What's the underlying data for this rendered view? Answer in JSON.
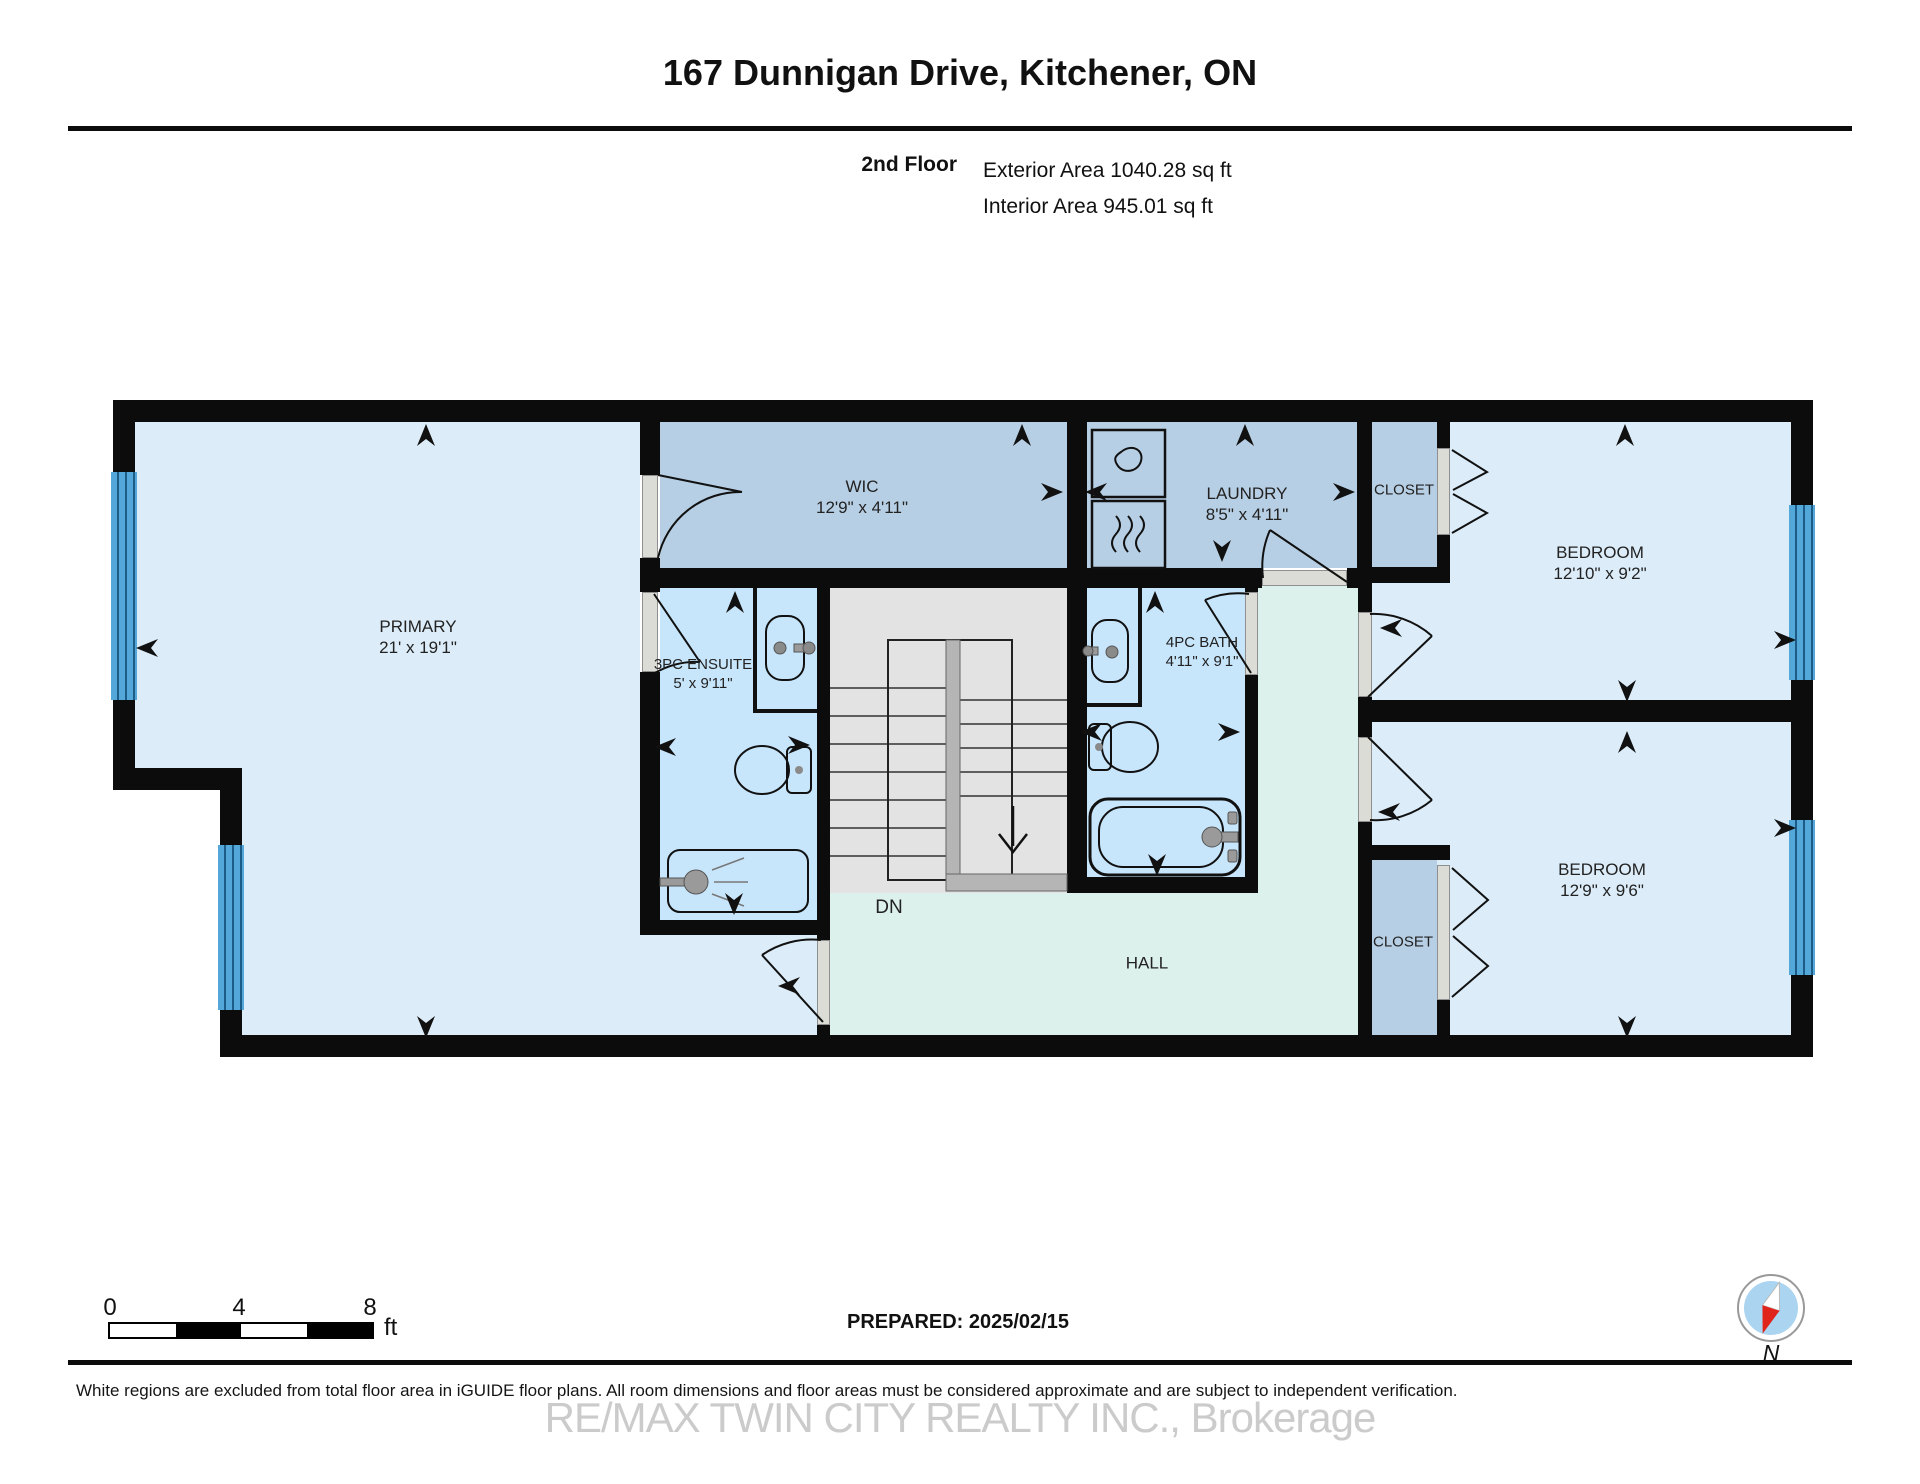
{
  "header": {
    "title": "167 Dunnigan Drive, Kitchener, ON",
    "floor_label": "2nd Floor",
    "exterior_area": "Exterior Area 1040.28 sq ft",
    "interior_area": "Interior Area 945.01 sq ft"
  },
  "rooms": {
    "primary": {
      "name": "PRIMARY",
      "dims": "21' x 19'1\""
    },
    "wic": {
      "name": "WIC",
      "dims": "12'9\" x 4'11\""
    },
    "laundry": {
      "name": "LAUNDRY",
      "dims": "8'5\" x 4'11\""
    },
    "closet_top": {
      "name": "CLOSET"
    },
    "bedroom_top": {
      "name": "BEDROOM",
      "dims": "12'10\" x 9'2\""
    },
    "bedroom_bottom": {
      "name": "BEDROOM",
      "dims": "12'9\" x 9'6\""
    },
    "ensuite": {
      "name": "3PC ENSUITE",
      "dims": "5' x 9'11\""
    },
    "bath": {
      "name": "4PC BATH",
      "dims": "4'11\" x 9'1\""
    },
    "hall": {
      "name": "HALL"
    },
    "closet_bottom": {
      "name": "CLOSET"
    },
    "stairs_label": "DN"
  },
  "scale_bar": {
    "tick0": "0",
    "tick4": "4",
    "tick8": "8",
    "unit": "ft"
  },
  "footer": {
    "prepared": "PREPARED: 2025/02/15",
    "disclaimer": "White regions are excluded from total floor area in iGUIDE floor plans. All room dimensions and floor areas must be considered approximate and are subject to independent verification.",
    "watermark": "RE/MAX TWIN CITY REALTY INC., Brokerage"
  },
  "compass": {
    "north_label": "N"
  },
  "colors": {
    "light": "#dcedf9",
    "medium": "#b7cfe4",
    "bright": "#c8e6fb",
    "mint": "#dcf0ec",
    "stairs": "#e3e3e3",
    "wall": "#0c0c0c",
    "window_glass": "#54a7d9",
    "window_line": "#1d5c87",
    "compass_blue": "#aad4f0",
    "compass_red": "#e0241c"
  }
}
